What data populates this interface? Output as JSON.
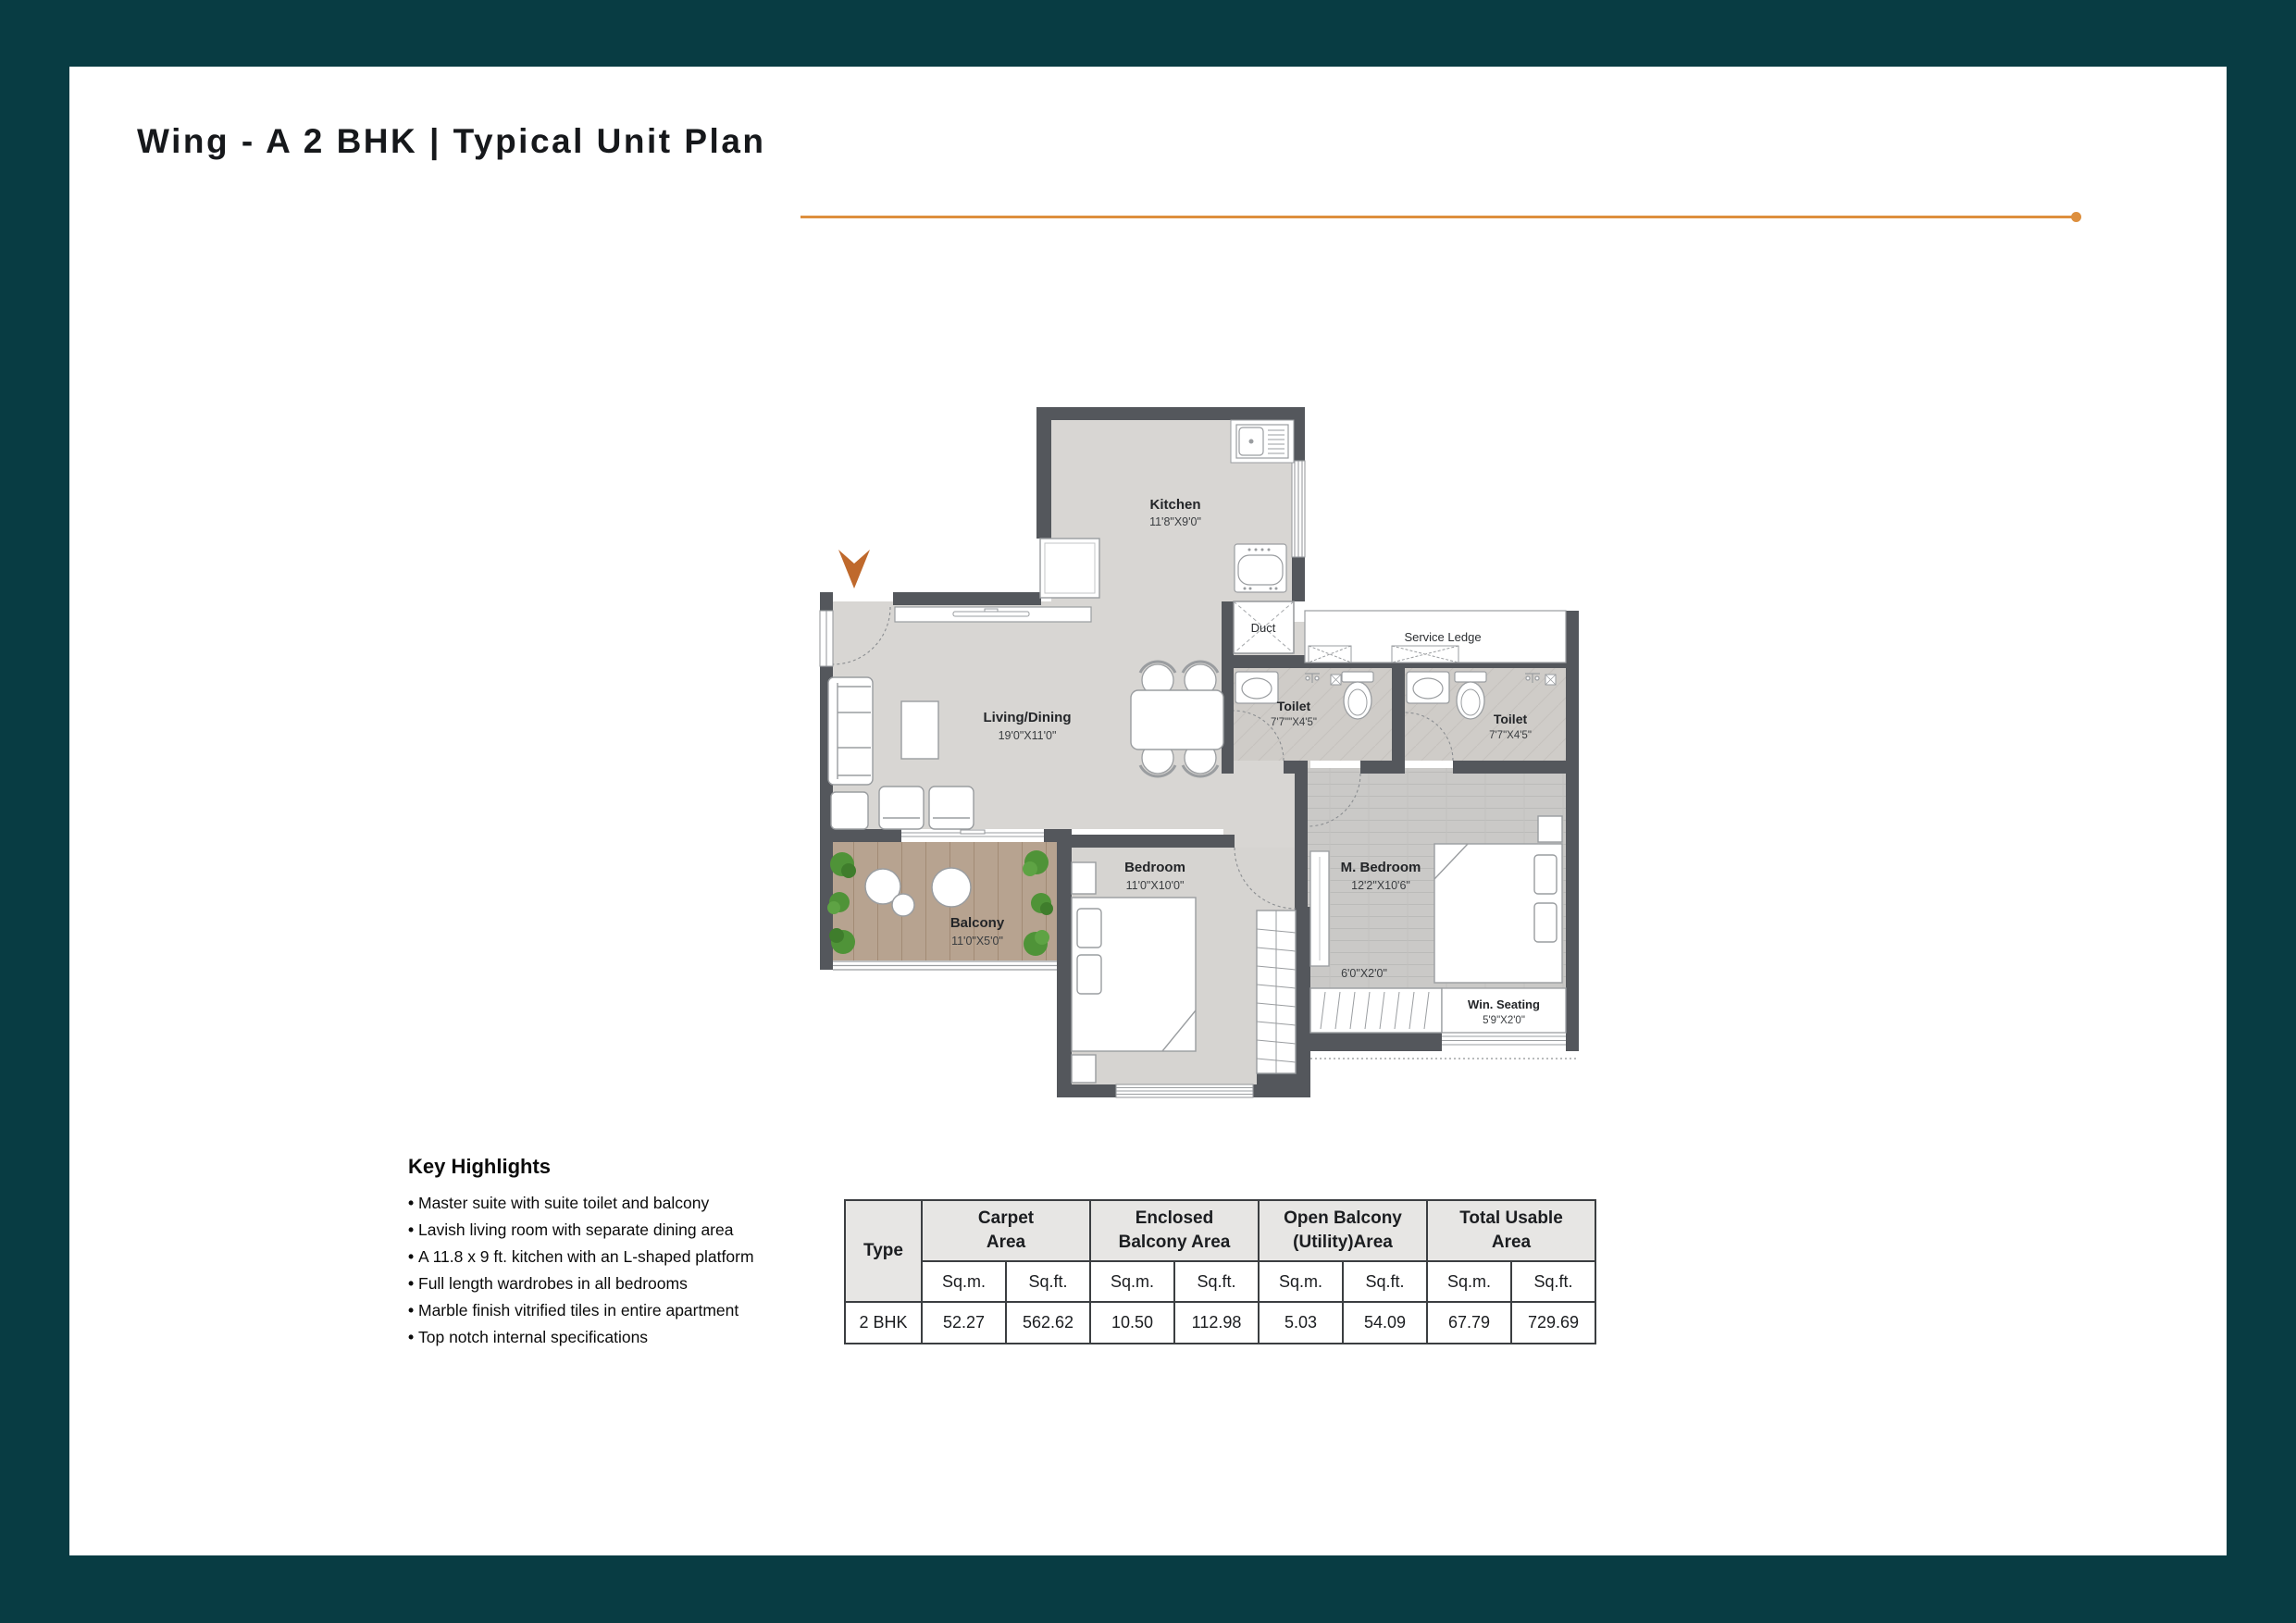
{
  "page": {
    "title": "Wing - A 2 BHK | Typical Unit Plan"
  },
  "colors": {
    "frame": "#083c43",
    "accent": "#dd8f3e",
    "wall": "#54575c",
    "arrow": "#bf692c"
  },
  "plan": {
    "rooms": [
      {
        "name": "Kitchen",
        "dims": "11'8\"X9'0\""
      },
      {
        "name": "Living/Dining",
        "dims": "19'0\"X11'0\""
      },
      {
        "name": "Duct",
        "dims": ""
      },
      {
        "name": "Service Ledge",
        "dims": ""
      },
      {
        "name": "Toilet",
        "dims": "7'7\"\"X4'5\""
      },
      {
        "name": "Toilet",
        "dims": "7'7\"X4'5\""
      },
      {
        "name": "M. Bedroom",
        "dims": "12'2\"X10'6\""
      },
      {
        "name": "Bedroom",
        "dims": "11'0\"X10'0\""
      },
      {
        "name": "Balcony",
        "dims": "11'0\"X5'0\""
      },
      {
        "name": "Win. Seating",
        "dims": "5'9\"X2'0\""
      },
      {
        "name": "Wardrobe",
        "dims": "6'0\"X2'0\""
      }
    ]
  },
  "highlights": {
    "heading": "Key Highlights",
    "items": [
      "Master suite with suite toilet and balcony",
      "Lavish living room with separate dining area",
      "A 11.8 x 9 ft. kitchen with an L-shaped platform",
      "Full length wardrobes in all bedrooms",
      "Marble finish vitrified tiles in entire apartment",
      "Top notch internal specifications"
    ]
  },
  "table": {
    "type_header": "Type",
    "groups": [
      {
        "l1": "Carpet",
        "l2": "Area"
      },
      {
        "l1": "Enclosed",
        "l2": "Balcony Area"
      },
      {
        "l1": "Open Balcony",
        "l2": "(Utility)Area"
      },
      {
        "l1": "Total Usable",
        "l2": "Area"
      }
    ],
    "units": [
      "Sq.m.",
      "Sq.ft.",
      "Sq.m.",
      "Sq.ft.",
      "Sq.m.",
      "Sq.ft.",
      "Sq.m.",
      "Sq.ft."
    ],
    "row_type": "2 BHK",
    "values": [
      "52.27",
      "562.62",
      "10.50",
      "112.98",
      "5.03",
      "54.09",
      "67.79",
      "729.69"
    ]
  }
}
